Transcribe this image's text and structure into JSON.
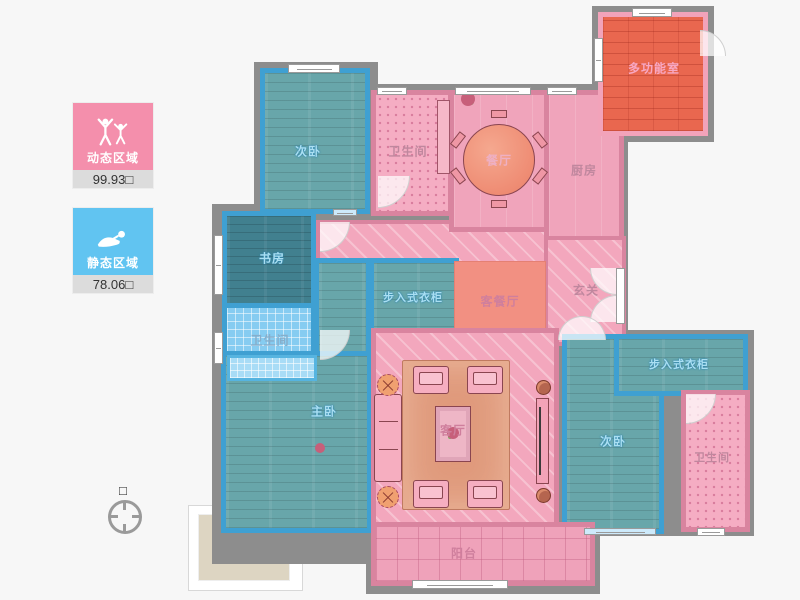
{
  "legend": {
    "dynamic": {
      "label": "动态区域",
      "value": "99.93",
      "unit": "□"
    },
    "static": {
      "label": "静态区域",
      "value": "78.06",
      "unit": "□"
    }
  },
  "compass": {
    "north_marker": "□"
  },
  "rooms": {
    "bedroom_top": "次卧",
    "bath_top": "卫生间",
    "dining": "餐厅",
    "kitchen": "厨房",
    "multi": "多功能室",
    "study": "书房",
    "closet_mid": "步入式衣柜",
    "living_dining": "客餐厅",
    "foyer": "玄关",
    "bath_left": "卫生间",
    "master": "主卧",
    "living": "客厅",
    "bedroom_right": "次卧",
    "closet_right": "步入式衣柜",
    "bath_right": "卫生间",
    "balcony": "阳台"
  },
  "colors": {
    "dynamic_accent": "#f48fac",
    "static_accent": "#61c4f1",
    "teal_room": "#68a6aa",
    "dark_teal_room": "#41808f",
    "blue_tile": "#86ccf1",
    "pink_room": "#f0a4bb",
    "pink_wall": "#d9849f",
    "blue_wall": "#3fa0d2",
    "salmon": "#f29082",
    "multi_room": "#e9674f",
    "outer_wall": "#8d8d8d"
  }
}
